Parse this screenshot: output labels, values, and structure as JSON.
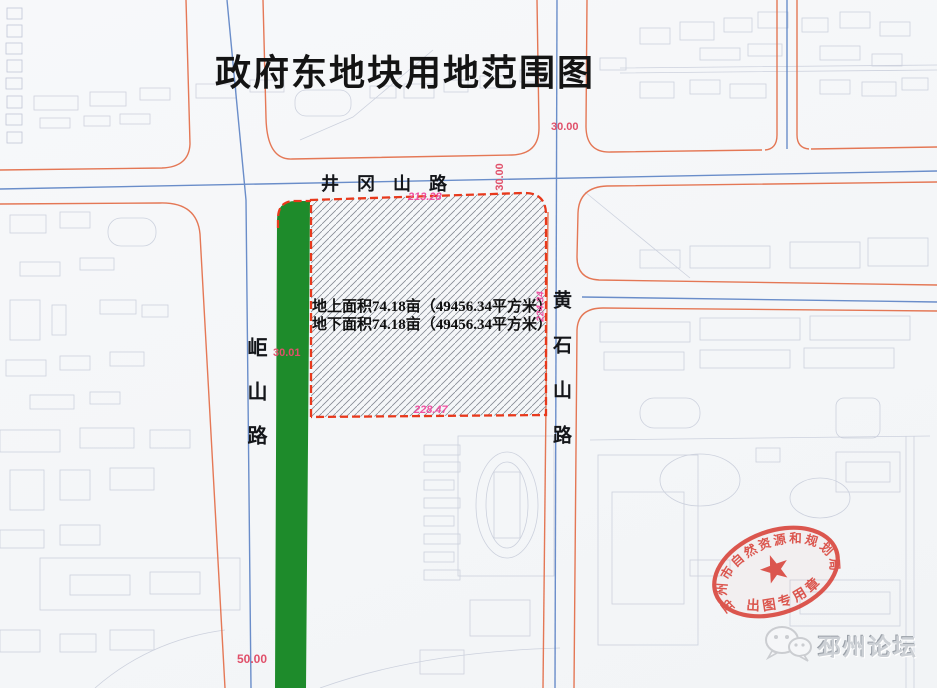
{
  "title": "政府东地块用地范围图",
  "roads": {
    "jinggangshan": "井冈山路",
    "jushan": "岠山路",
    "huangshishan": "黄石山路"
  },
  "plot": {
    "area_above": "地上面积74.18亩（49456.34平方米）",
    "area_below": "地下面积74.18亩（49456.34平方米）",
    "dim_top": "213.28",
    "dim_bottom": "228.47",
    "dim_right": "224.34",
    "greenbelt_width": "30.01",
    "road_width_horizontal": "30.00",
    "road_width_vertical": "30.00",
    "offset_bottom": "50.00"
  },
  "seal": {
    "ring_text": "邳州市自然资源和规划局",
    "banner_text": "出图专用章",
    "star_icon": "red-star"
  },
  "watermark": {
    "text": "邳州论坛",
    "logo_icon": "wechat-chat-bubbles"
  },
  "colors": {
    "greenbelt": "#1e8b2b",
    "plot_border": "#e8391c",
    "curb_orange": "#e4714d",
    "centerline_blue": "#5b82c4",
    "dimension_red": "#e0506a",
    "dimension_pink": "#f052a2",
    "seal_red": "#d9453c",
    "faint_line": "#c6cbd9"
  }
}
